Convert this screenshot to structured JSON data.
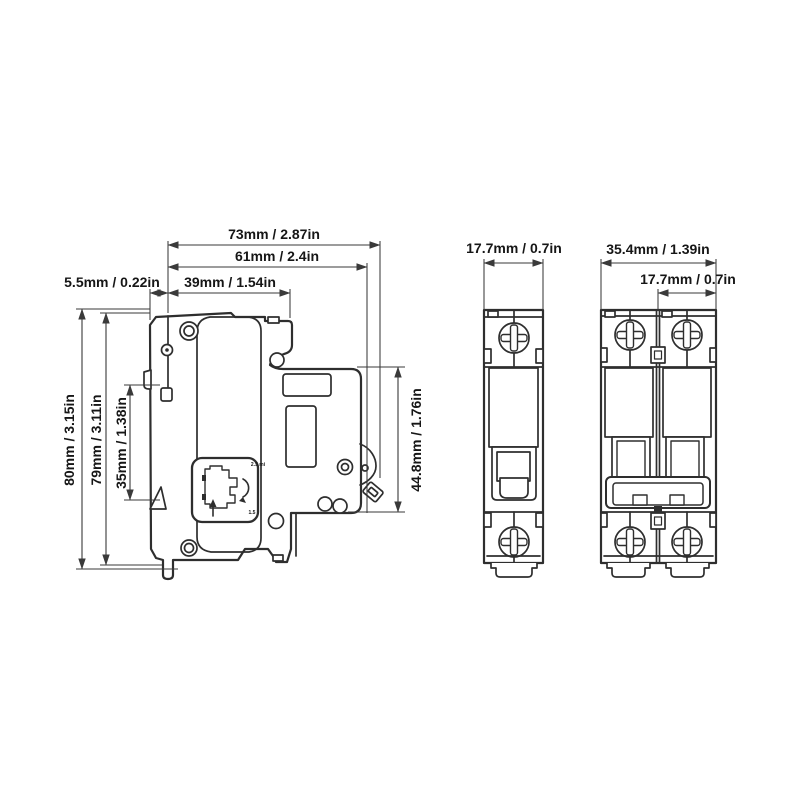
{
  "drawing_title": "circuit-breaker-dimension-drawing",
  "colors": {
    "background": "#ffffff",
    "line": "#2e2e2e",
    "dimension_line": "#3a3a3a",
    "text": "#161616"
  },
  "side_view": {
    "dim_total_width": "73mm / 2.87in",
    "dim_body_width": "61mm / 2.4in",
    "dim_front_width": "39mm / 1.54in",
    "dim_rail_depth": "5.5mm / 0.22in",
    "dim_total_height": "80mm / 3.15in",
    "dim_body_height": "79mm / 3.11in",
    "dim_rail_slot_height": "35mm / 1.38in",
    "dim_face_height": "44.8mm / 1.76in",
    "detail_top_label": "2.5 mi",
    "detail_bottom_label": "1.5"
  },
  "front_view_single": {
    "dim_width": "17.7mm / 0.7in"
  },
  "front_view_double": {
    "dim_total_width": "35.4mm / 1.39in",
    "dim_pole_width": "17.7mm / 0.7in"
  }
}
